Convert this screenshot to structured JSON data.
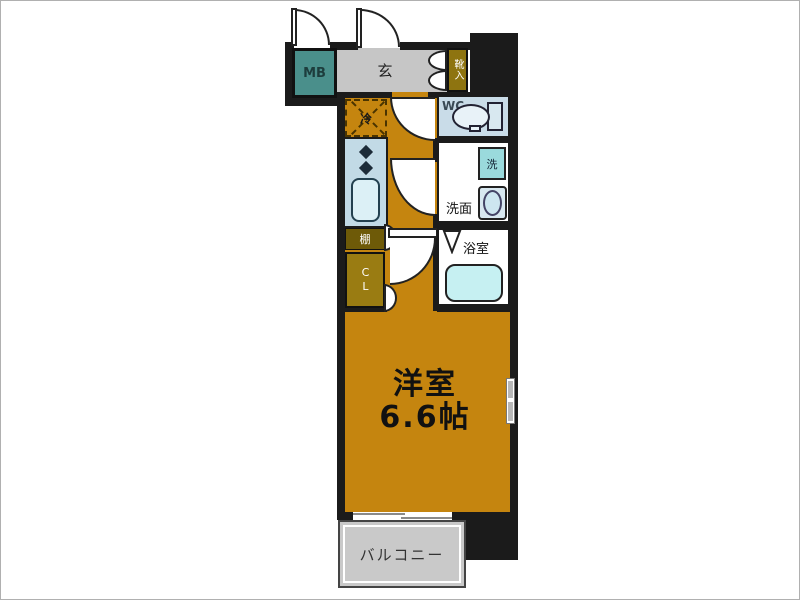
{
  "rooms": {
    "meter_box": {
      "label": "MB"
    },
    "entrance": {
      "label": "玄"
    },
    "shoe_storage": {
      "label": "靴入"
    },
    "refrigerator": {
      "label": "冷"
    },
    "toilet": {
      "label": "WC"
    },
    "washer": {
      "label": "洗"
    },
    "washroom": {
      "label": "洗面"
    },
    "bathroom": {
      "label": "浴室"
    },
    "shelf": {
      "label": "棚"
    },
    "closet": {
      "label": "CL"
    },
    "western_room": {
      "label": "洋室",
      "size": "6.6帖"
    },
    "balcony": {
      "label": "バルコニー"
    }
  },
  "colors": {
    "wall": "#1b1b1b",
    "floor_orange": "#c5850f",
    "entrance_gray": "#c6c6c6",
    "mb_teal": "#4a8f8b",
    "shelf_dark_olive": "#6e5a08",
    "closet_olive": "#9a7c12",
    "shoe_olive": "#8e7410",
    "wc_lightblue": "#c9dce8",
    "kitchen_blue": "#c2dae6",
    "fixture_blue": "#d8e8f0",
    "tub_cyan": "#c6f0f2",
    "washer_teal": "#9adadc",
    "balcony_gray": "#c9c9c9"
  }
}
